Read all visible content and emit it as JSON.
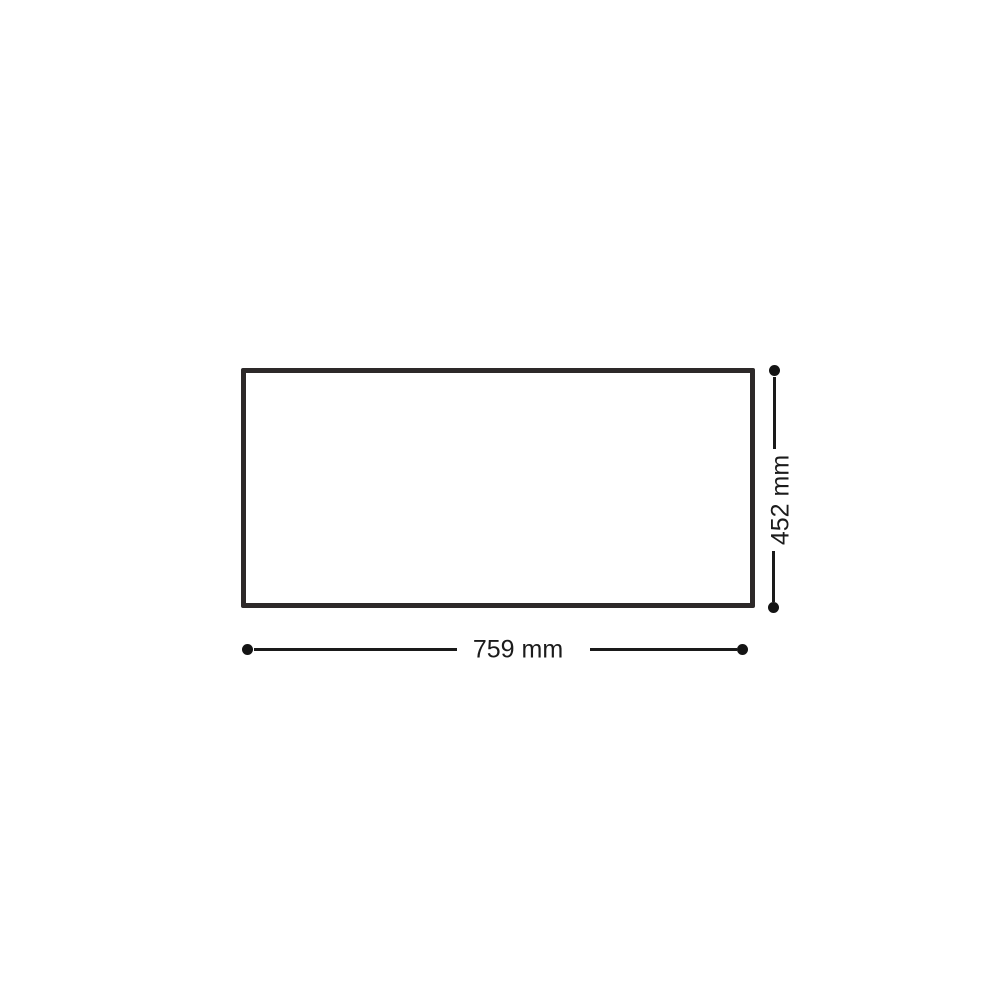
{
  "diagram": {
    "type": "dimension-drawing",
    "shape": "rectangle",
    "width_label": "759 mm",
    "height_label": "452 mm",
    "colors": {
      "outline": "#2d2929",
      "dimension_lines": "#1a1a1a",
      "endpoint_dots": "#141414",
      "text": "#1b1b1b",
      "background": "#ffffff"
    }
  }
}
